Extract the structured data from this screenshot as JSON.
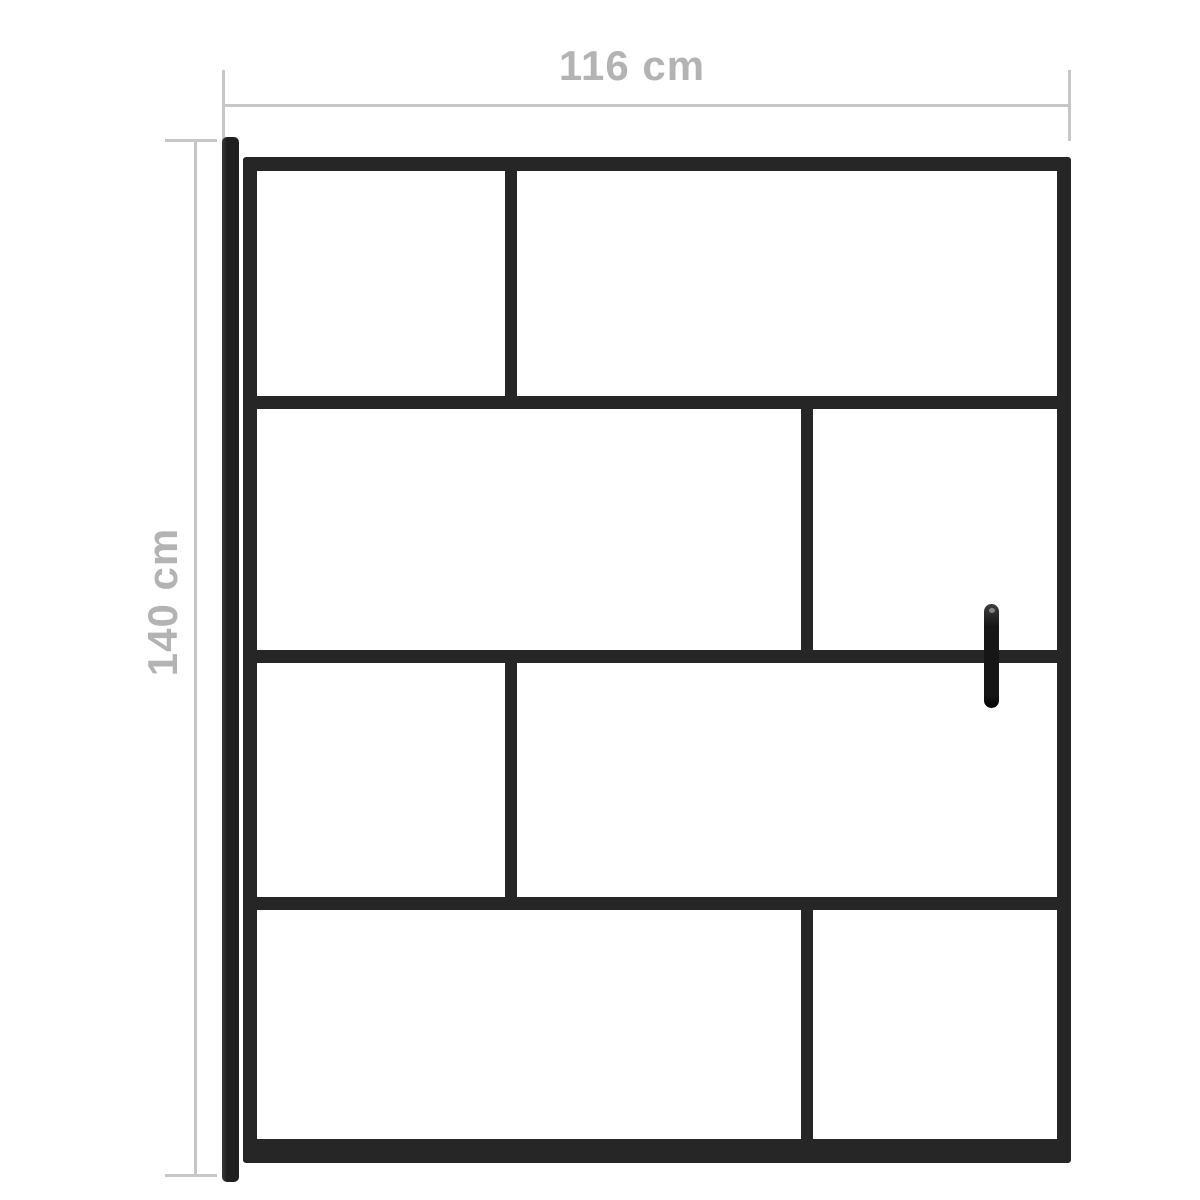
{
  "title": "Shower screen dimension diagram",
  "colors": {
    "background": "#ffffff",
    "frame": "#262626",
    "wall_profile": "#1f1f1f",
    "handle": "#161616",
    "dim_line": "#c6c6c6",
    "dim_text": "#b3b3b3"
  },
  "dimensions": {
    "width_label": "116 cm",
    "height_label": "140 cm"
  },
  "diagram": {
    "type": "product-dimension-diagram",
    "subject": "black-framed glass shower screen with wall profile and handle",
    "glass_rows": 4,
    "row_divider_x_fraction": [
      0.32,
      0.69,
      0.32,
      0.69
    ],
    "handle_side": "right",
    "wall_profile_side": "left"
  }
}
